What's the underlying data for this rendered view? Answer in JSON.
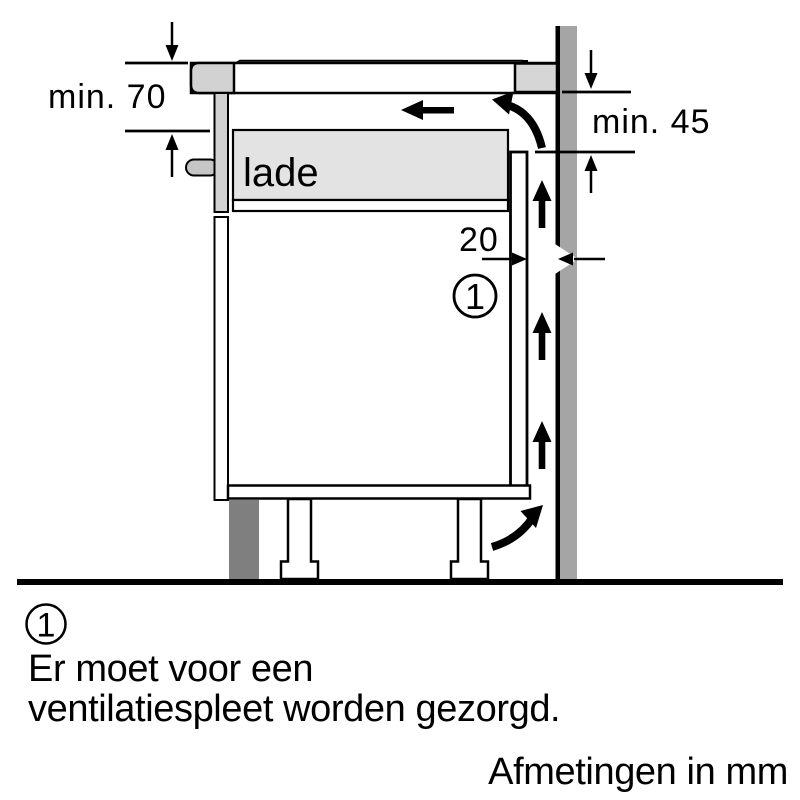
{
  "diagram": {
    "labels": {
      "min_clearance_top": "min. 70",
      "min_clearance_right": "min. 45",
      "rear_gap": "20",
      "drawer": "lade",
      "callout_marker": "1"
    },
    "colors": {
      "wall": "#a5a5a5",
      "plinth": "#7f7f7f",
      "trim": "#d2d2d2",
      "hob_right_trim": "#d6d6d6",
      "drawer_fill": "#e3e3e3",
      "handle": "#c6c6c6",
      "outline": "#000000"
    }
  },
  "footnote": {
    "marker": "1",
    "line1": "Er moet voor een",
    "line2": "ventilatiespleet worden gezorgd."
  },
  "units_note": "Afmetingen in mm"
}
